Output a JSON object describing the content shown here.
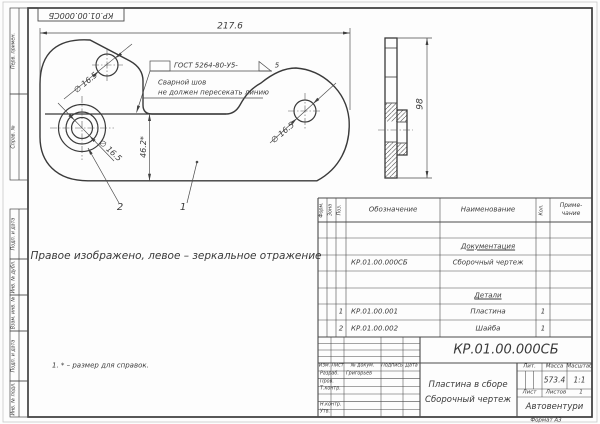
{
  "sheet": {
    "format_label": "Формат А3"
  },
  "stamp_top": {
    "text": "КР.01.00.000СБ"
  },
  "margin": {
    "labels": [
      "Перв. примен.",
      "Справ. №",
      "Подп. и дата",
      "Инв. № дубл.",
      "Взам. инв. №",
      "Подп. и дата",
      "Инв. № подл."
    ]
  },
  "drawing": {
    "dim_width": "217.6",
    "dim_height_side": "98",
    "dim_ref": "46.2*",
    "hole_labels": [
      "∅ 16.5",
      "∅ 16.5",
      "∅ 16.5"
    ],
    "weld": {
      "gost": "ГОСТ 5264-80-У5-",
      "leg": "5",
      "note_line1": "Сварной шов",
      "note_line2": "не должен пересекать линию"
    },
    "callout_plate": "1",
    "callout_washer": "2",
    "note_mirror": "Правое изображено, левое – зеркальное отражение",
    "note_ref": "1. * – размер для справок."
  },
  "spec": {
    "headers": {
      "format": "Форм.",
      "zone": "Зона",
      "pos": "Поз.",
      "designation": "Обозначение",
      "name": "Наименование",
      "qty": "Кол.",
      "note1": "Приме-",
      "note2": "чание"
    },
    "section_docs": "Документация",
    "section_parts": "Детали",
    "rows": [
      {
        "pos": "",
        "designation": "КР.01.00.000СБ",
        "name": "Сборочный чертеж",
        "qty": ""
      },
      {
        "pos": "1",
        "designation": "КР.01.00.001",
        "name": "Пластина",
        "qty": "1"
      },
      {
        "pos": "2",
        "designation": "КР.01.00.002",
        "name": "Шайба",
        "qty": "1"
      }
    ]
  },
  "title_block": {
    "designation": "КР.01.00.000СБ",
    "doc_name": "Пластина в сборе",
    "doc_type": "Сборочный чертеж",
    "company": "Автовентури",
    "header": {
      "izm": "Изм.",
      "list": "Лист",
      "doc": "№ докум.",
      "sign": "Подпись",
      "date": "Дата"
    },
    "roles": {
      "developed_label": "Разраб.",
      "developed_name": "Григорьев",
      "checked_label": "Пров.",
      "tcontrol_label": "Т.контр.",
      "ncontrol_label": "Н.контр.",
      "approved_label": "Утв."
    },
    "litera_label": "Лит.",
    "mass_label": "Масса",
    "scale_label": "Масштаб",
    "mass": "573.4",
    "scale": "1:1",
    "sheet_label": "Лист",
    "sheets_label": "Листов",
    "sheets_value": "1"
  }
}
